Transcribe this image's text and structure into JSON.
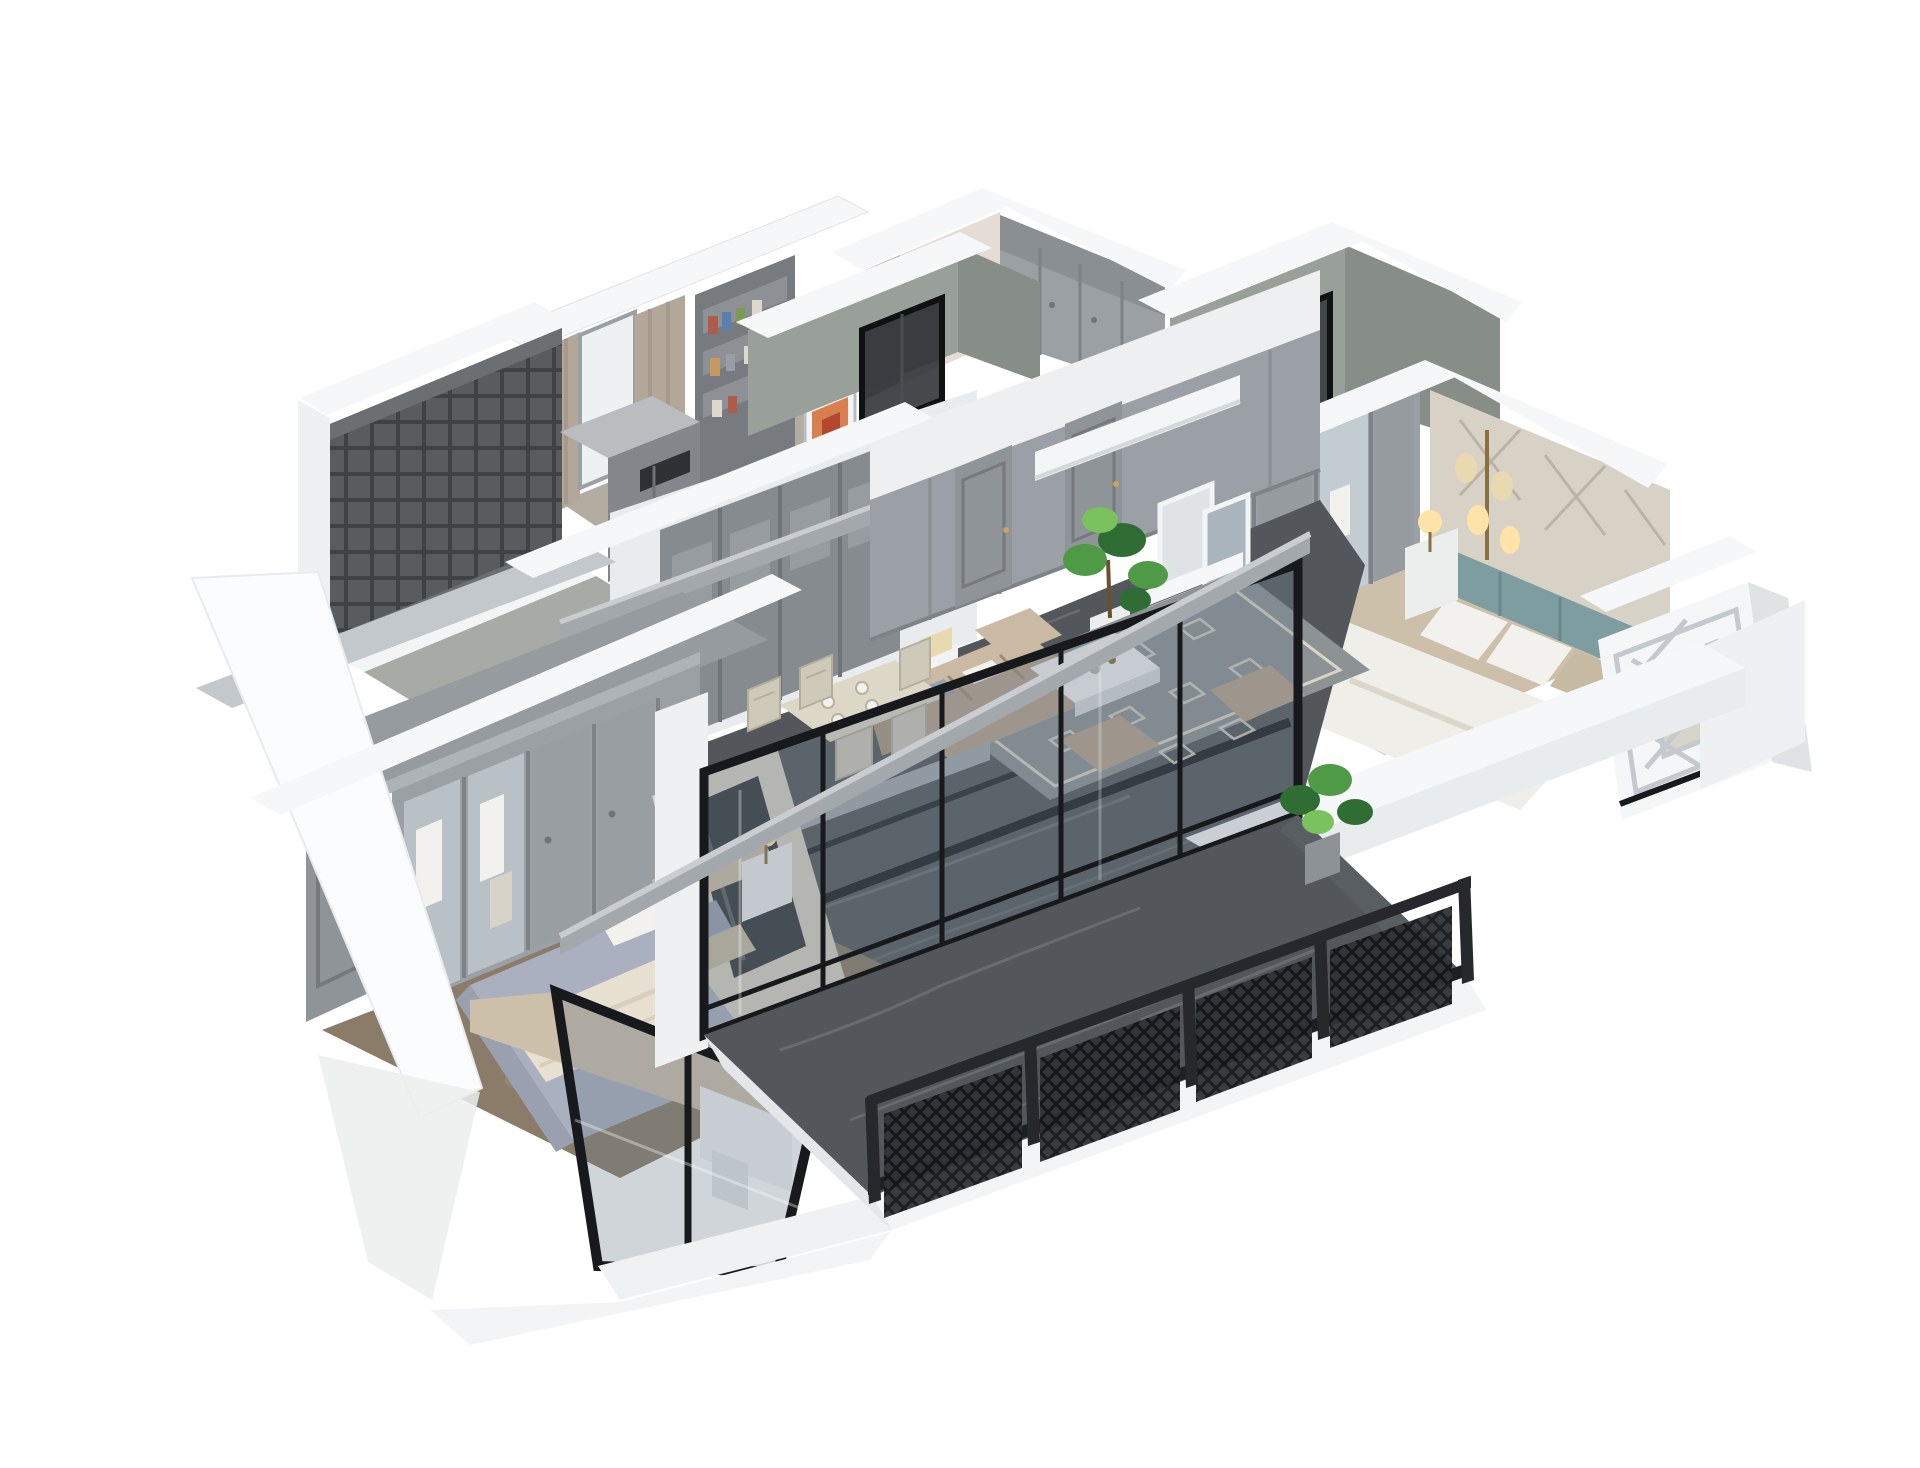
{
  "meta": {
    "type": "3d-apartment-dollhouse-render",
    "description": "Isometric cutaway 3D rendering of a furnished apartment floor plan on a white background",
    "background": "#ffffff"
  },
  "palette": {
    "background": "#ffffff",
    "white_wall_top": "#f6f7f8",
    "white_wall_face": "#e9ecee",
    "white_wall_shade": "#d9dde0",
    "panel_gray": "#9aa0a5",
    "panel_gray_dark": "#7c8186",
    "door_gray": "#8f9499",
    "cement_wall": "#99a09a",
    "cement_wall_dark": "#878e88",
    "pink_wall": "#e6dcd6",
    "curtain_tan": "#b3a79a",
    "marble_floor": "#53575c",
    "marble_floor_light": "#6a6e73",
    "marble_vein": "#84888d",
    "inlay_black": "#1a1c1f",
    "rug_gray": "#8d9295",
    "rug_pattern": "#d9d4c6",
    "sofa_taupe": "#b5a38e",
    "sofa_highlight": "#cbbaa3",
    "coffee_table_white": "#f1f2f3",
    "dining_cream": "#ddd7c8",
    "chair_cream": "#cfc9ba",
    "carpet_brown": "#8a7c68",
    "carpet_mottle": "#9b8d77",
    "wood_floor": "#cdc0ab",
    "bed_lavender": "#aab0bf",
    "bed_throw_cream": "#e8e1d1",
    "pillow_white": "#f2f1ed",
    "pillow_blue": "#97a1b4",
    "pillow_tan": "#c6baa2",
    "bed_white": "#f0eee8",
    "headboard_beige": "#cdbfa8",
    "teal_headboard": "#7d9da0",
    "upholstered_beige": "#d8d1c5",
    "upholstered_line": "#bab3a6",
    "glass_tint": "rgba(110,125,140,0.32)",
    "glass_frame_black": "#17191c",
    "railing_black": "#26282b",
    "plant_green_dark": "#2f6d35",
    "plant_green": "#4e9a46",
    "plant_green_light": "#79c25e",
    "fire_orange": "#ff9d33",
    "fire_yellow": "#ffd27a",
    "lamp_glow": "#ffe3a8",
    "lamp_shade": "#e8d9b0",
    "beam_gray": "#a3a8ad",
    "beam_gray_light": "#c9cdd1",
    "lattice_white": "#c3c9ce",
    "bookshelf_gray": "#777b80",
    "fireplace_white": "#eff1f2",
    "firebox_black": "#26221f"
  },
  "rooms": [
    {
      "id": "balcony",
      "label": "terrace-balcony",
      "floor": "dark-marble",
      "feature": "black-lattice-railing"
    },
    {
      "id": "living-room",
      "label": "living-room",
      "floor": "dark-marble",
      "feature": "fireplace-and-sofa"
    },
    {
      "id": "dining-area",
      "label": "dining-area",
      "floor": "dark-marble",
      "feature": "cream-dining-set"
    },
    {
      "id": "hallway",
      "label": "hallway",
      "floor": "dark-marble",
      "feature": "gray-paneled-sliding-wall"
    },
    {
      "id": "master-bedroom",
      "label": "master-bedroom",
      "floor": "brown-carpet",
      "feature": "glass-front-wardrobe"
    },
    {
      "id": "bedroom-2",
      "label": "second-bedroom",
      "floor": "light-wood",
      "feature": "teal-headboard-and-lamps"
    },
    {
      "id": "closet-bedroom",
      "label": "bedroom-with-wardrobes",
      "floor": "light-wood",
      "feature": "pink-walls"
    },
    {
      "id": "bathroom-1",
      "label": "bathroom",
      "floor": "tile",
      "feature": "cement-green-walls-glass-shower"
    },
    {
      "id": "bathroom-2",
      "label": "bathroom",
      "floor": "tile",
      "feature": "cement-green-walls"
    },
    {
      "id": "study",
      "label": "study",
      "floor": "light-wood",
      "feature": "bookshelf-and-curtains"
    },
    {
      "id": "utility-balcony",
      "label": "utility-balcony",
      "floor": "stone",
      "feature": "dark-lattice-screen"
    },
    {
      "id": "bay-window",
      "label": "bay-window-block",
      "floor": "white",
      "feature": "diamond-lattice-window"
    }
  ]
}
